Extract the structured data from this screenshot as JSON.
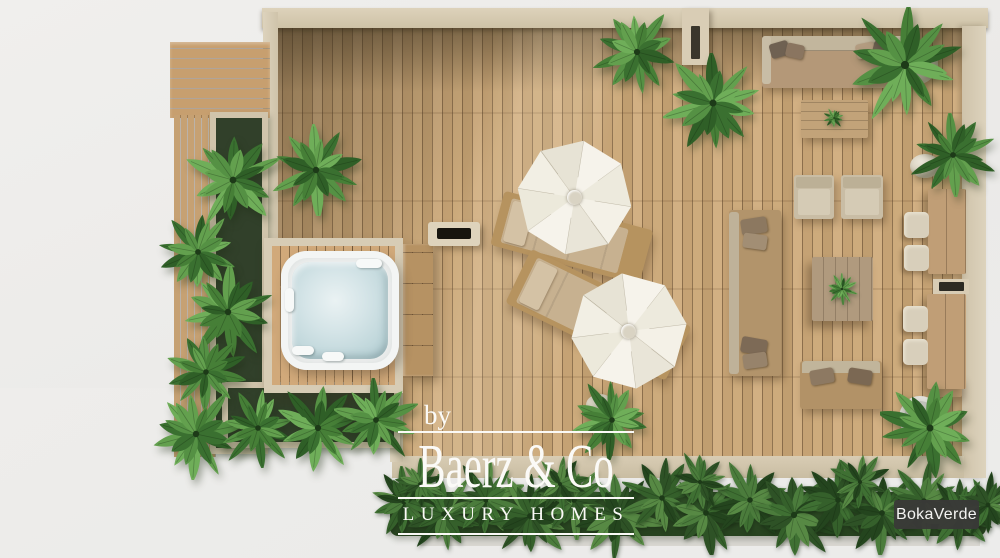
{
  "branding": {
    "by_label": "by",
    "company_name": "Baerz & Co",
    "tagline": "LUXURY HOMES"
  },
  "watermark": {
    "brand": "BokaVerde"
  },
  "palette": {
    "deck_wood": "#c9a77b",
    "wall_cream": "#d8cdb6",
    "foliage_green": "#4e8a40",
    "hedge_green": "#2e5226",
    "water_blue": "#cfe0e3",
    "cushion_beige": "#cfc4ae",
    "umbrella_white": "#f4f1e8",
    "badge_dark": "#3f3f3d",
    "background_gray": "#ececeb"
  }
}
